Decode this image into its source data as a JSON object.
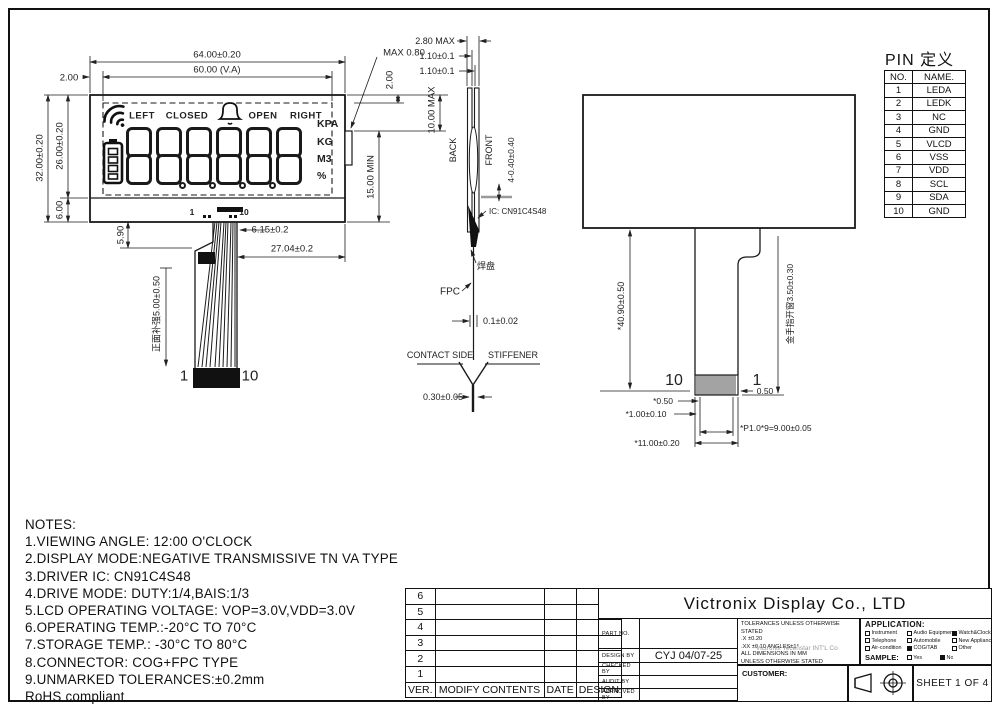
{
  "front_view": {
    "display": {
      "status_labels": [
        "LEFT",
        "CLOSED",
        "OPEN",
        "RIGHT"
      ],
      "digits": "888888",
      "unit_labels": [
        "KPA",
        "KG",
        "M3",
        "%"
      ]
    },
    "pin_marks": {
      "first": "1",
      "last": "10"
    },
    "tail_pins": {
      "left": "1",
      "right": "10"
    },
    "dims": {
      "width_outer": "64.00±0.20",
      "width_va": "60.00 (V.A)",
      "left_margin": "2.00",
      "height_outer": "32.00±0.20",
      "height_va": "26.00±0.20",
      "bottom_strip": "6.00",
      "tab_thickness": "MAX 0.80",
      "right_top": "2.00",
      "right_max": "10.00 MAX",
      "right_min": "15.00 MIN",
      "fpc_drop": "5.90",
      "connector_width": "6.15±0.2",
      "fpc_to_edge": "27.04±0.2",
      "front_stiffener": "正面补强5.00±0.50"
    }
  },
  "side_view": {
    "dims": {
      "total_thickness": "2.80 MAX",
      "glass1": "1.10±0.1",
      "glass2": "1.10±0.1",
      "ic_bump": "4-0.40±0.40",
      "fpc_thickness": "0.1±0.02",
      "stiffener_thickness": "0.30±0.05"
    },
    "labels": {
      "back": "BACK",
      "front": "FRONT",
      "ic": "IC: CN91C4S48",
      "solder_pad": "焊盘",
      "fpc": "FPC",
      "contact_side": "CONTACT SIDE",
      "stiffener": "STIFFENER"
    }
  },
  "rear_view": {
    "tail_pins": {
      "left": "10",
      "right": "1"
    },
    "dims": {
      "tail_length": "*40.90±0.50",
      "finger_window": "金手指开窗3.50±0.30",
      "pin_margin": "*0.50",
      "edge_margin": "0.50",
      "pin_width": "*1.00±0.10",
      "pitch": "*P1.0*9=9.00±0.05",
      "connector_width": "*11.00±0.20"
    }
  },
  "pin_table": {
    "title": "PIN 定义",
    "headers": [
      "NO.",
      "NAME."
    ],
    "rows": [
      [
        "1",
        "LEDA"
      ],
      [
        "2",
        "LEDK"
      ],
      [
        "3",
        "NC"
      ],
      [
        "4",
        "GND"
      ],
      [
        "5",
        "VLCD"
      ],
      [
        "6",
        "VSS"
      ],
      [
        "7",
        "VDD"
      ],
      [
        "8",
        "SCL"
      ],
      [
        "9",
        "SDA"
      ],
      [
        "10",
        "GND"
      ]
    ]
  },
  "notes": {
    "title": "NOTES:",
    "lines": [
      "1.VIEWING ANGLE: 12:00 O'CLOCK",
      "2.DISPLAY MODE:NEGATIVE TRANSMISSIVE TN VA TYPE",
      "3.DRIVER IC: CN91C4S48",
      "4.DRIVE MODE: DUTY:1/4,BAIS:1/3",
      "5.LCD OPERATING VOLTAGE: VOP=3.0V,VDD=3.0V",
      "6.OPERATING TEMP.:-20°C TO 70°C",
      "7.STORAGE TEMP.: -30°C TO 80°C",
      "8.CONNECTOR: COG+FPC TYPE",
      "9.UNMARKED TOLERANCES:±0.2mm",
      " RoHS compliant"
    ]
  },
  "revision_table": {
    "versions": [
      "6",
      "5",
      "4",
      "3",
      "2",
      "1"
    ],
    "headers": [
      "VER.",
      "MODIFY CONTENTS",
      "DATE",
      "DESIGN"
    ]
  },
  "title_block": {
    "company": "Victronix Display Co., LTD",
    "part_no_label": "PART NO.",
    "design_by_label": "DESIGN BY",
    "design_by_value": "CYJ  04/07-25",
    "checked_by_label": "CHECKED BY",
    "audit_by_label": "AUDIT  BY",
    "approved_by_label": "APPROVED BY",
    "tolerances": {
      "line1": "TOLERANCES UNLESS OTHERWISE STATED",
      "line2": ".X  ±0.20",
      "line3": ".XX ±0.10     ANGLES±1°",
      "line4": "ALL DIMENSIONS IN MM",
      "line5": "UNLESS OTHERWISE STATED",
      "watermark": "Victronix Tecenstar INT'L Co"
    },
    "application": {
      "label": "APPLICATION:",
      "items": [
        {
          "label": "Instrument",
          "checked": false
        },
        {
          "label": "Audio Equipment",
          "checked": false
        },
        {
          "label": "Watch&Clock",
          "checked": true
        },
        {
          "label": "Telephone",
          "checked": false
        },
        {
          "label": "Automobile",
          "checked": false
        },
        {
          "label": "New Appliance",
          "checked": false
        },
        {
          "label": "Air-condition",
          "checked": false
        },
        {
          "label": "COG/TAB",
          "checked": true
        },
        {
          "label": "Other",
          "checked": false
        }
      ],
      "sample_label": "SAMPLE:",
      "sample_options": [
        {
          "label": "Yes",
          "checked": false
        },
        {
          "label": "No",
          "checked": true
        }
      ]
    },
    "customer_label": "CUSTOMER:",
    "sheet": "SHEET 1 OF 4"
  }
}
